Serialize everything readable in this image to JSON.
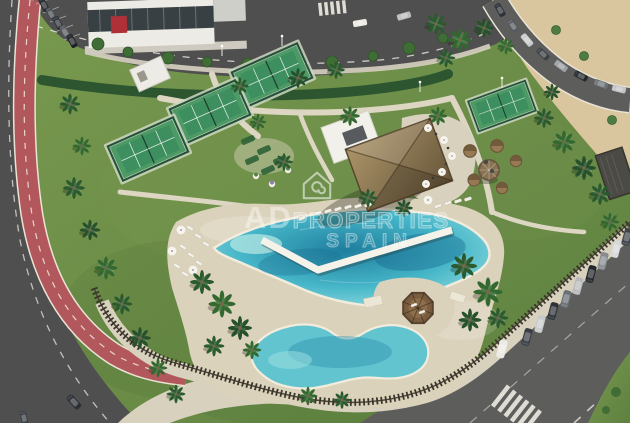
{
  "watermark": {
    "brand_primary": "AD",
    "brand_secondary": "PROPERTIES",
    "brand_location": "SPAIN"
  },
  "palette": {
    "lawn": "#6d9149",
    "lawn_shade": "#567a38",
    "sand": "#d9c69e",
    "asphalt": "#4f4f4f",
    "asphalt_light": "#5d5d5c",
    "bike_lane": "#b2585c",
    "concrete": "#d8d1bd",
    "deck": "#dbd2bb",
    "hedge": "#2c5530",
    "fence": "#3b362c",
    "pool_deep": "#1f7e9e",
    "pool_mid": "#46b6c8",
    "pool_light": "#9de0e2",
    "pool_shallow": "#62c4cf",
    "court_green": "#4d9a66",
    "court_turf": "#3e8f5f",
    "thatch": "#97825c",
    "white_building": "#ecebe5",
    "awning_red": "#b03038"
  }
}
